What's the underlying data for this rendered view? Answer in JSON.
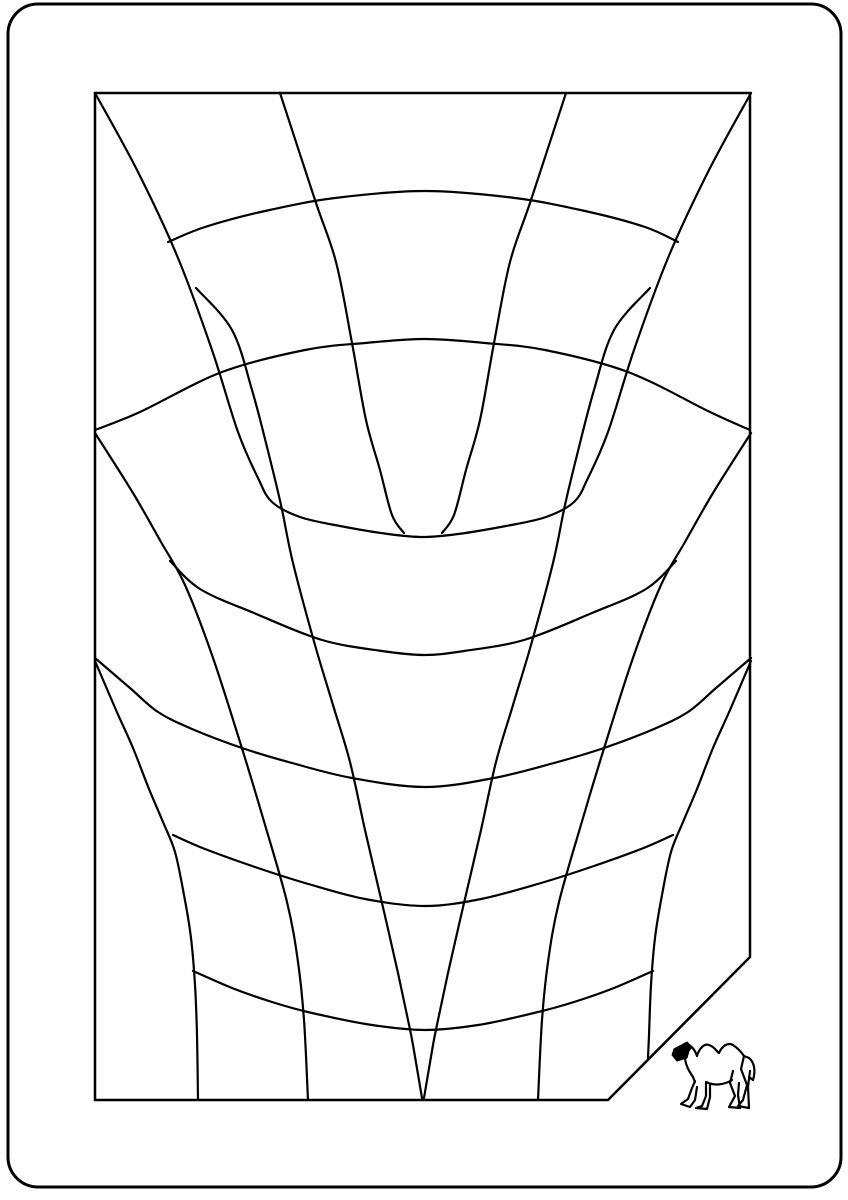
{
  "meta": {
    "kind": "monochrome-line-figure",
    "background_color": "#ffffff",
    "ink_color": "#000000"
  },
  "figure": {
    "width": 848,
    "height": 1200,
    "outer_border": {
      "x": 8,
      "y": 4,
      "width": 833,
      "height": 1183,
      "radius": 30,
      "stroke_width": 3
    },
    "inner_frame": {
      "stroke_width": 2.5,
      "closed": true,
      "points": [
        [
          95,
          93
        ],
        [
          750,
          93
        ],
        [
          750,
          957
        ],
        [
          608,
          1100
        ],
        [
          95,
          1100
        ]
      ]
    },
    "curve_stroke_width": 2.2,
    "curves": [
      {
        "name": "corner-contour-hairpin",
        "points": [
          [
            95,
            93
          ],
          [
            138,
            172
          ],
          [
            178,
            258
          ],
          [
            212,
            350
          ],
          [
            238,
            432
          ],
          [
            258,
            478
          ],
          [
            272,
            502
          ],
          [
            300,
            517
          ],
          [
            340,
            526
          ],
          [
            388,
            534
          ],
          [
            423,
            537
          ],
          [
            458,
            534
          ],
          [
            506,
            526
          ],
          [
            546,
            517
          ],
          [
            574,
            502
          ],
          [
            588,
            478
          ],
          [
            608,
            432
          ],
          [
            634,
            350
          ],
          [
            668,
            258
          ],
          [
            708,
            172
          ],
          [
            751,
            93
          ]
        ]
      },
      {
        "name": "v-line-left",
        "points": [
          [
            196,
            288
          ],
          [
            232,
            330
          ],
          [
            252,
            390
          ],
          [
            267,
            447
          ],
          [
            281,
            505
          ],
          [
            293,
            563
          ],
          [
            315,
            645
          ],
          [
            333,
            705
          ],
          [
            350,
            762
          ],
          [
            365,
            830
          ],
          [
            382,
            903
          ],
          [
            398,
            973
          ],
          [
            408,
            1020
          ],
          [
            413,
            1045
          ],
          [
            422,
            1098
          ]
        ]
      },
      {
        "name": "v-line-right",
        "points": [
          [
            650,
            288
          ],
          [
            614,
            330
          ],
          [
            594,
            390
          ],
          [
            579,
            447
          ],
          [
            565,
            505
          ],
          [
            553,
            563
          ],
          [
            531,
            645
          ],
          [
            513,
            705
          ],
          [
            496,
            762
          ],
          [
            481,
            830
          ],
          [
            464,
            903
          ],
          [
            448,
            973
          ],
          [
            438,
            1020
          ],
          [
            433,
            1045
          ],
          [
            424,
            1098
          ]
        ]
      },
      {
        "name": "dome-arc-top",
        "points": [
          [
            168,
            242
          ],
          [
            205,
            227
          ],
          [
            265,
            211
          ],
          [
            335,
            198
          ],
          [
            425,
            191
          ],
          [
            515,
            198
          ],
          [
            585,
            211
          ],
          [
            645,
            227
          ],
          [
            678,
            242
          ]
        ]
      },
      {
        "name": "dome-arc-second",
        "points": [
          [
            95,
            430
          ],
          [
            140,
            412
          ],
          [
            222,
            372
          ],
          [
            305,
            350
          ],
          [
            365,
            343
          ],
          [
            425,
            339
          ],
          [
            485,
            343
          ],
          [
            545,
            350
          ],
          [
            628,
            372
          ],
          [
            710,
            412
          ],
          [
            750,
            430
          ]
        ]
      },
      {
        "name": "fan-line-inner-left",
        "points": [
          [
            280,
            93
          ],
          [
            315,
            200
          ],
          [
            336,
            262
          ],
          [
            352,
            343
          ],
          [
            366,
            420
          ],
          [
            380,
            470
          ],
          [
            392,
            515
          ],
          [
            404,
            533
          ]
        ]
      },
      {
        "name": "fan-line-inner-right",
        "points": [
          [
            566,
            93
          ],
          [
            531,
            200
          ],
          [
            510,
            262
          ],
          [
            494,
            343
          ],
          [
            480,
            420
          ],
          [
            466,
            470
          ],
          [
            454,
            515
          ],
          [
            442,
            533
          ]
        ]
      },
      {
        "name": "side-line-left-upper",
        "points": [
          [
            95,
            433
          ],
          [
            133,
            493
          ],
          [
            161,
            542
          ],
          [
            185,
            585
          ],
          [
            212,
            655
          ],
          [
            240,
            742
          ],
          [
            263,
            818
          ],
          [
            287,
            902
          ],
          [
            298,
            962
          ],
          [
            304,
            1020
          ],
          [
            308,
            1100
          ]
        ]
      },
      {
        "name": "side-line-right-upper",
        "points": [
          [
            751,
            433
          ],
          [
            713,
            493
          ],
          [
            685,
            542
          ],
          [
            661,
            585
          ],
          [
            634,
            655
          ],
          [
            606,
            742
          ],
          [
            583,
            818
          ],
          [
            559,
            902
          ],
          [
            548,
            962
          ],
          [
            542,
            1020
          ],
          [
            538,
            1100
          ]
        ]
      },
      {
        "name": "side-line-left-lower",
        "points": [
          [
            95,
            661
          ],
          [
            116,
            710
          ],
          [
            133,
            748
          ],
          [
            149,
            789
          ],
          [
            163,
            822
          ],
          [
            175,
            852
          ],
          [
            184,
            895
          ],
          [
            191,
            938
          ],
          [
            195,
            985
          ],
          [
            197,
            1035
          ],
          [
            198,
            1100
          ]
        ]
      },
      {
        "name": "side-line-right-lower",
        "points": [
          [
            751,
            661
          ],
          [
            730,
            710
          ],
          [
            713,
            748
          ],
          [
            697,
            789
          ],
          [
            683,
            822
          ],
          [
            671,
            852
          ],
          [
            662,
            895
          ],
          [
            655,
            938
          ],
          [
            651,
            985
          ],
          [
            649,
            1035
          ],
          [
            648,
            1058
          ]
        ]
      },
      {
        "name": "smile-arc-mid",
        "points": [
          [
            170,
            561
          ],
          [
            200,
            589
          ],
          [
            254,
            613
          ],
          [
            322,
            640
          ],
          [
            382,
            651
          ],
          [
            425,
            655
          ],
          [
            464,
            651
          ],
          [
            524,
            640
          ],
          [
            592,
            613
          ],
          [
            646,
            589
          ],
          [
            676,
            561
          ]
        ]
      },
      {
        "name": "smile-arc-wide",
        "points": [
          [
            95,
            658
          ],
          [
            130,
            688
          ],
          [
            158,
            712
          ],
          [
            192,
            729
          ],
          [
            242,
            748
          ],
          [
            292,
            763
          ],
          [
            352,
            778
          ],
          [
            425,
            787
          ],
          [
            494,
            778
          ],
          [
            554,
            763
          ],
          [
            604,
            748
          ],
          [
            654,
            729
          ],
          [
            688,
            712
          ],
          [
            716,
            688
          ],
          [
            751,
            658
          ]
        ]
      },
      {
        "name": "smile-arc-low",
        "points": [
          [
            173,
            835
          ],
          [
            205,
            849
          ],
          [
            255,
            867
          ],
          [
            305,
            883
          ],
          [
            365,
            899
          ],
          [
            425,
            906
          ],
          [
            481,
            899
          ],
          [
            541,
            883
          ],
          [
            591,
            867
          ],
          [
            641,
            849
          ],
          [
            673,
            835
          ]
        ]
      },
      {
        "name": "smile-arc-bottom",
        "points": [
          [
            193,
            971
          ],
          [
            232,
            988
          ],
          [
            272,
            1002
          ],
          [
            312,
            1013
          ],
          [
            372,
            1025
          ],
          [
            425,
            1030
          ],
          [
            478,
            1025
          ],
          [
            534,
            1013
          ],
          [
            574,
            1002
          ],
          [
            614,
            988
          ],
          [
            653,
            971
          ]
        ]
      }
    ],
    "camel": {
      "x": 672,
      "y": 1040,
      "width": 96,
      "height": 73,
      "stroke_width": 2.2,
      "head_fill_path": "M2,9 L15,2 L20,7 L17,11 L15,18 L5,21 L0,15 Z",
      "outline_paths": [
        "M15,4 C20,6 23,10 25,16 C27,9 32,3 37,5 C43,7 45,12 47,13 C50,6 56,2 61,5 C67,9 70,13 72,16 L77,18",
        "M77,18 C82,22 84,30 81,40 L77,37",
        "M72,16 L69,29 L75,45 L71,60 L66,66 L77,68 L76,47 L78,31",
        "M61,31 L58,43 L63,56 L57,67 L68,68 L66,55 L67,43",
        "M60,40 C52,45 42,46 34,42",
        "M34,42 L34,56 L30,66 L24,68 L35,69 L38,57 L38,44",
        "M23,41 L20,48 L16,59 L9,64 L18,67 L23,60 L25,47",
        "M13,19 C14,26 17,31 21,37 L23,42"
      ]
    }
  }
}
